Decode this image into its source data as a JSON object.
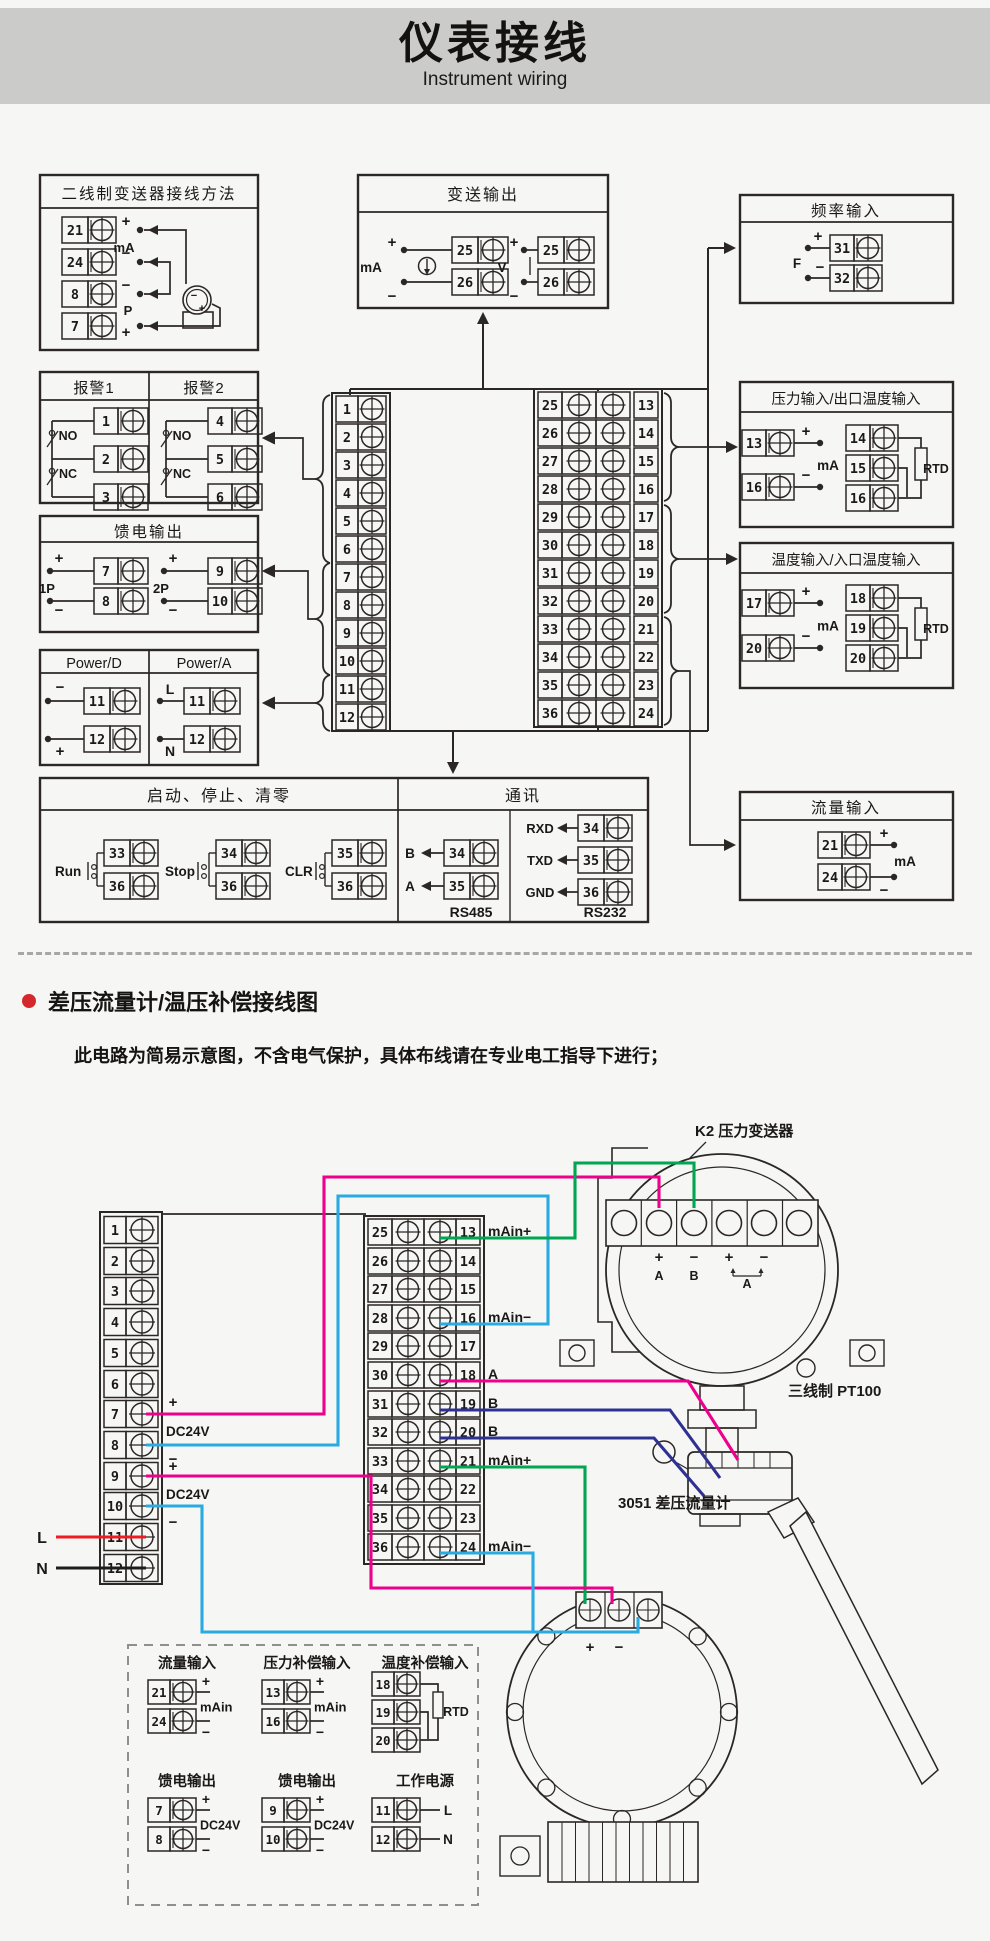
{
  "header": {
    "title": "仪表接线",
    "subtitle": "Instrument wiring"
  },
  "top": {
    "two_wire": {
      "title": "二线制变送器接线方法",
      "t": [
        "21",
        "24",
        "8",
        "7"
      ],
      "plus_top": "+",
      "ma": "mA",
      "minus_mid": "−",
      "minus_low": "−",
      "p": "P",
      "plus_bot": "+",
      "tx_minus": "−",
      "tx_plus": "+"
    },
    "alarm": {
      "title_1": "报警1",
      "title_2": "报警2",
      "g1_t": [
        "1",
        "2",
        "3"
      ],
      "g2_t": [
        "4",
        "5",
        "6"
      ],
      "no": "NO",
      "nc": "NC"
    },
    "feed": {
      "title": "馈电输出",
      "g1_name": "1P",
      "g2_name": "2P",
      "g1_t": [
        "7",
        "8"
      ],
      "g2_t": [
        "9",
        "10"
      ],
      "plus": "+",
      "minus": "−"
    },
    "power": {
      "title_d": "Power/D",
      "title_a": "Power/A",
      "d_t": [
        "11",
        "12"
      ],
      "a_t": [
        "11",
        "12"
      ],
      "d_s1": "−",
      "d_s2": "+",
      "a_s1": "L",
      "a_s2": "N"
    },
    "runstop": {
      "title": "启动、停止、清零",
      "items": [
        {
          "label": "Run",
          "t1": "33",
          "t2": "36"
        },
        {
          "label": "Stop",
          "t1": "34",
          "t2": "36"
        },
        {
          "label": "CLR",
          "t1": "35",
          "t2": "36"
        }
      ]
    },
    "comm": {
      "title": "通讯",
      "rs485_label": "RS485",
      "rs485": [
        {
          "sig": "B",
          "t": "34"
        },
        {
          "sig": "A",
          "t": "35"
        }
      ],
      "rs232_label": "RS232",
      "rs232": [
        {
          "sig": "RXD",
          "t": "34"
        },
        {
          "sig": "TXD",
          "t": "35"
        },
        {
          "sig": "GND",
          "t": "36"
        }
      ]
    },
    "transmit": {
      "title": "变送输出",
      "ma_label": "mA",
      "v_label": "V",
      "ma_t": [
        "25",
        "26"
      ],
      "v_t": [
        "25",
        "26"
      ],
      "plus": "+",
      "minus": "−"
    },
    "freq": {
      "title": "频率输入",
      "f": "F",
      "t": [
        "31",
        "32"
      ],
      "plus": "+",
      "minus": "−"
    },
    "pressure": {
      "title": "压力输入/出口温度输入",
      "ma_t": [
        "13",
        "16"
      ],
      "rtd_t": [
        "14",
        "15",
        "16"
      ],
      "ma": "mA",
      "rtd": "RTD",
      "plus": "+",
      "minus": "−"
    },
    "temp": {
      "title": "温度输入/入口温度输入",
      "ma_t": [
        "17",
        "20"
      ],
      "rtd_t": [
        "18",
        "19",
        "20"
      ],
      "ma": "mA",
      "rtd": "RTD",
      "plus": "+",
      "minus": "−"
    },
    "flow": {
      "title": "流量输入",
      "t": [
        "21",
        "24"
      ],
      "ma": "mA",
      "plus": "+",
      "minus": "−"
    },
    "strip_left": [
      "1",
      "2",
      "3",
      "4",
      "5",
      "6",
      "7",
      "8",
      "9",
      "10",
      "11",
      "12"
    ],
    "strip_right_a": [
      "25",
      "26",
      "27",
      "28",
      "29",
      "30",
      "31",
      "32",
      "33",
      "34",
      "35",
      "36"
    ],
    "strip_right_b": [
      "13",
      "14",
      "15",
      "16",
      "17",
      "18",
      "19",
      "20",
      "21",
      "22",
      "23",
      "24"
    ]
  },
  "section": {
    "title": "差压流量计/温压补偿接线图",
    "note": "此电路为简易示意图，不含电气保护，具体布线请在专业电工指导下进行；"
  },
  "bottom": {
    "strip_left": [
      "1",
      "2",
      "3",
      "4",
      "5",
      "6",
      "7",
      "8",
      "9",
      "10",
      "11",
      "12"
    ],
    "left_labels": {
      "p7": "+",
      "dc1": "DC24V",
      "m8": "−",
      "p9": "+",
      "dc2": "DC24V",
      "m10": "−",
      "l": "L",
      "n": "N"
    },
    "strip_center_a": [
      "25",
      "26",
      "27",
      "28",
      "29",
      "30",
      "31",
      "32",
      "33",
      "34",
      "35",
      "36"
    ],
    "strip_center_b": [
      "13",
      "14",
      "15",
      "16",
      "17",
      "18",
      "19",
      "20",
      "21",
      "22",
      "23",
      "24"
    ],
    "pin_labels": [
      {
        "row": 1,
        "text": "mAin+"
      },
      {
        "row": 4,
        "text": "mAin−"
      },
      {
        "row": 6,
        "text": "A"
      },
      {
        "row": 7,
        "text": "B"
      },
      {
        "row": 8,
        "text": "B"
      },
      {
        "row": 9,
        "text": "mAin+"
      },
      {
        "row": 12,
        "text": "mAin−"
      }
    ],
    "k2": {
      "label": "K2 压力变送器",
      "signs": [
        "+",
        "−",
        "+",
        "−"
      ],
      "a": "A",
      "b": "B",
      "a2": "A"
    },
    "pt100": {
      "label": "三线制  PT100"
    },
    "dp": {
      "label": "3051 差压流量计",
      "plus": "+",
      "minus": "−"
    },
    "legend": {
      "flow": {
        "title": "流量输入",
        "t": [
          "21",
          "24"
        ],
        "plus": "+",
        "minus": "−",
        "ma": "mAin"
      },
      "pcomp": {
        "title": "压力补偿输入",
        "t": [
          "13",
          "16"
        ],
        "plus": "+",
        "minus": "−",
        "ma": "mAin"
      },
      "tcomp": {
        "title": "温度补偿输入",
        "t": [
          "18",
          "19",
          "20"
        ],
        "rtd": "RTD"
      },
      "feed1": {
        "title": "馈电输出",
        "t": [
          "7",
          "8"
        ],
        "plus": "+",
        "minus": "−",
        "dc": "DC24V"
      },
      "feed2": {
        "title": "馈电输出",
        "t": [
          "9",
          "10"
        ],
        "plus": "+",
        "minus": "−",
        "dc": "DC24V"
      },
      "psu": {
        "title": "工作电源",
        "t": [
          "11",
          "12"
        ],
        "l": "L",
        "n": "N"
      }
    }
  },
  "colors": {
    "accent_bullet": "#d5282d",
    "wire_magenta": "#ec008c",
    "wire_cyan": "#29abe2",
    "wire_green": "#00a651",
    "wire_navy": "#2e3192",
    "wire_red": "#ed1c24",
    "wire_black": "#1f1d1b",
    "line": "#2b2725",
    "header_bg": "#cbcbc9"
  }
}
